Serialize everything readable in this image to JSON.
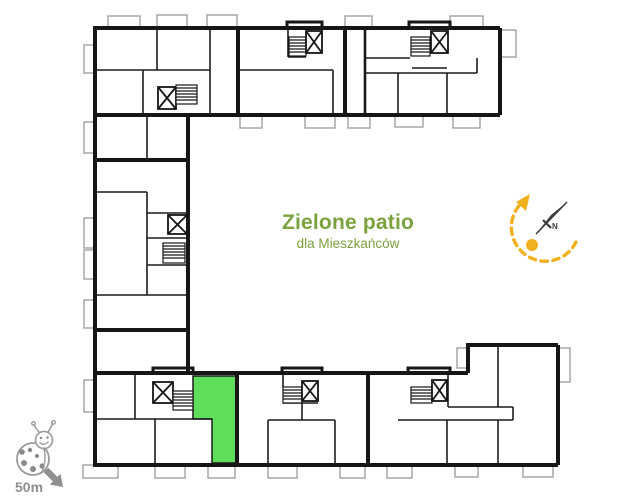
{
  "patio": {
    "title": "Zielone patio",
    "subtitle": "dla Mieszkańców",
    "text_color": "#7aa23e"
  },
  "highlighted_unit": {
    "fill": "#5ede5a"
  },
  "compass": {
    "north_label": "N",
    "needle_color": "#3d3d3d",
    "sun_color": "#f0b11e"
  },
  "scale_indicator": {
    "label": "50m",
    "color": "#8f8f8f"
  },
  "plan_colors": {
    "walls": "#161616",
    "balconies": "#9a9a9a"
  }
}
